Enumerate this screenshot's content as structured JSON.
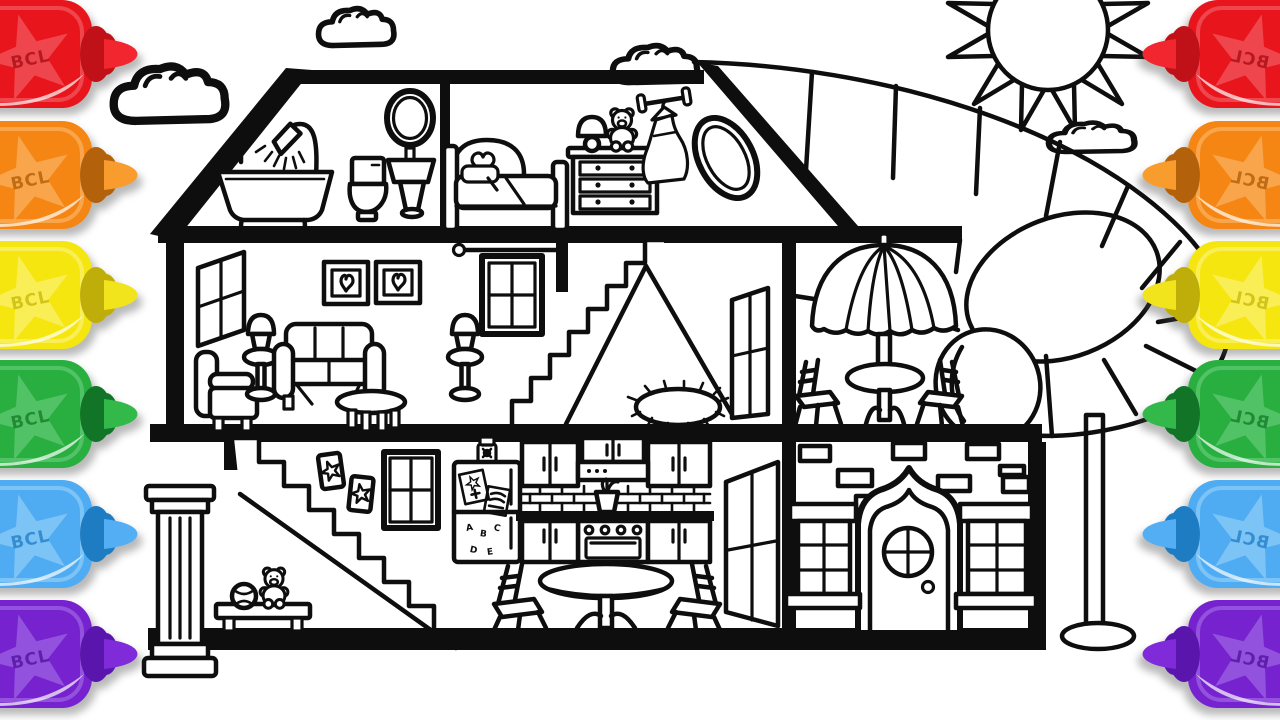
{
  "markers": {
    "label": "BCL",
    "palette": [
      {
        "name": "red",
        "body": "#E8151D",
        "star": "#EF464D",
        "text": "#A80F15",
        "cap": "#BF1117",
        "nib": "#F2262E"
      },
      {
        "name": "orange",
        "body": "#F58613",
        "star": "#F8A54B",
        "text": "#B35E08",
        "cap": "#B4610B",
        "nib": "#F89C2D"
      },
      {
        "name": "yellow",
        "body": "#F6E60F",
        "star": "#F9EE55",
        "text": "#C9BA0A",
        "cap": "#BFAE09",
        "nib": "#F2E41C"
      },
      {
        "name": "green",
        "body": "#28AF3F",
        "star": "#52C267",
        "text": "#157D28",
        "cap": "#117427",
        "nib": "#33B94A"
      },
      {
        "name": "blue",
        "body": "#4FABF2",
        "star": "#7CC3F6",
        "text": "#2380C8",
        "cap": "#1E7CC2",
        "nib": "#54AEF4"
      },
      {
        "name": "purple",
        "body": "#7622CE",
        "star": "#9352DD",
        "text": "#5313A0",
        "cap": "#5A16AC",
        "nib": "#7F2BD9"
      }
    ],
    "left_side_count": 6,
    "right_side_count": 6,
    "right_side_mirrored": true
  },
  "fridge": {
    "magnets": [
      "A",
      "B",
      "C",
      "D",
      "E"
    ]
  },
  "scene": {
    "sky": [
      "sun",
      "cloud",
      "cloud",
      "cloud",
      "cloud"
    ],
    "outdoor": [
      "spiral-tube-slide",
      "slide-support-pole"
    ],
    "attic": {
      "bathroom": [
        "shower",
        "bathtub",
        "toilet",
        "pedestal-sink",
        "oval-mirror"
      ],
      "bedroom": [
        "heart-bed",
        "lamp",
        "teddy-bear",
        "dresser",
        "clothes-rod-with-dress",
        "porthole-window"
      ]
    },
    "second_floor": {
      "living_room": [
        "side-window",
        "armchair",
        "lamp-table",
        "sofa",
        "heart-picture",
        "heart-picture",
        "lamp-table",
        "coffee-table",
        "window",
        "curtain-rod"
      ],
      "stairwell": [
        "staircase",
        "fringed-rug",
        "open-door"
      ],
      "patio": [
        "umbrella",
        "patio-table",
        "chair",
        "chair"
      ]
    },
    "ground_floor": {
      "hall": [
        "column",
        "staircase",
        "toy-bench",
        "teddy-bear",
        "ball",
        "star-picture",
        "star-picture",
        "window"
      ],
      "kitchen": [
        "jar",
        "fridge",
        "wall-cabinets",
        "range-hood",
        "brick-backsplash",
        "plant-pot",
        "counter",
        "stove",
        "dining-table",
        "chair",
        "chair",
        "open-door"
      ],
      "facade": [
        "bricks",
        "arched-front-door",
        "round-door-window",
        "window",
        "window"
      ]
    }
  },
  "colors": {
    "line": "#0e0e0e",
    "background": "#ffffff"
  }
}
